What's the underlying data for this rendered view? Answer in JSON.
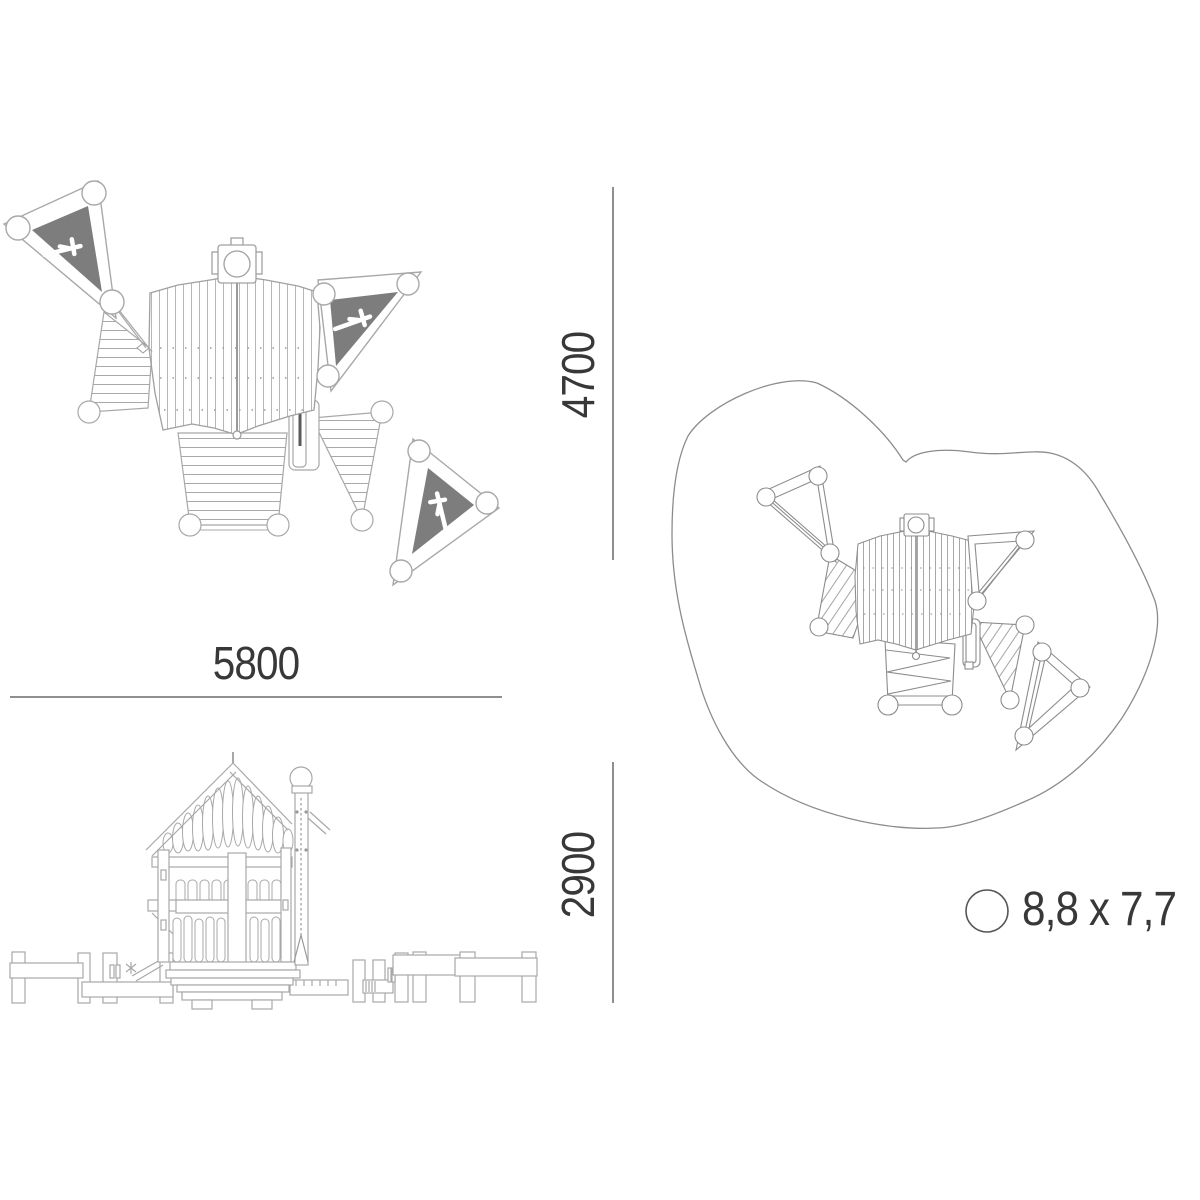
{
  "dimensions": {
    "width": "5800",
    "depth": "4700",
    "height": "2900"
  },
  "safety_area": "8,8 x 7,7",
  "colors": {
    "dimension_text": "#383838",
    "dimension_line": "#8f8f8f",
    "drawing_line": "#a8a8a8",
    "site_line": "#8c8c8c",
    "sail_fill": "#7d7d7d",
    "icon_color": "#ffffff",
    "background": "#ffffff"
  },
  "icons": {
    "climber": "climber-figure-icon",
    "safety_marker": "circle-icon"
  }
}
